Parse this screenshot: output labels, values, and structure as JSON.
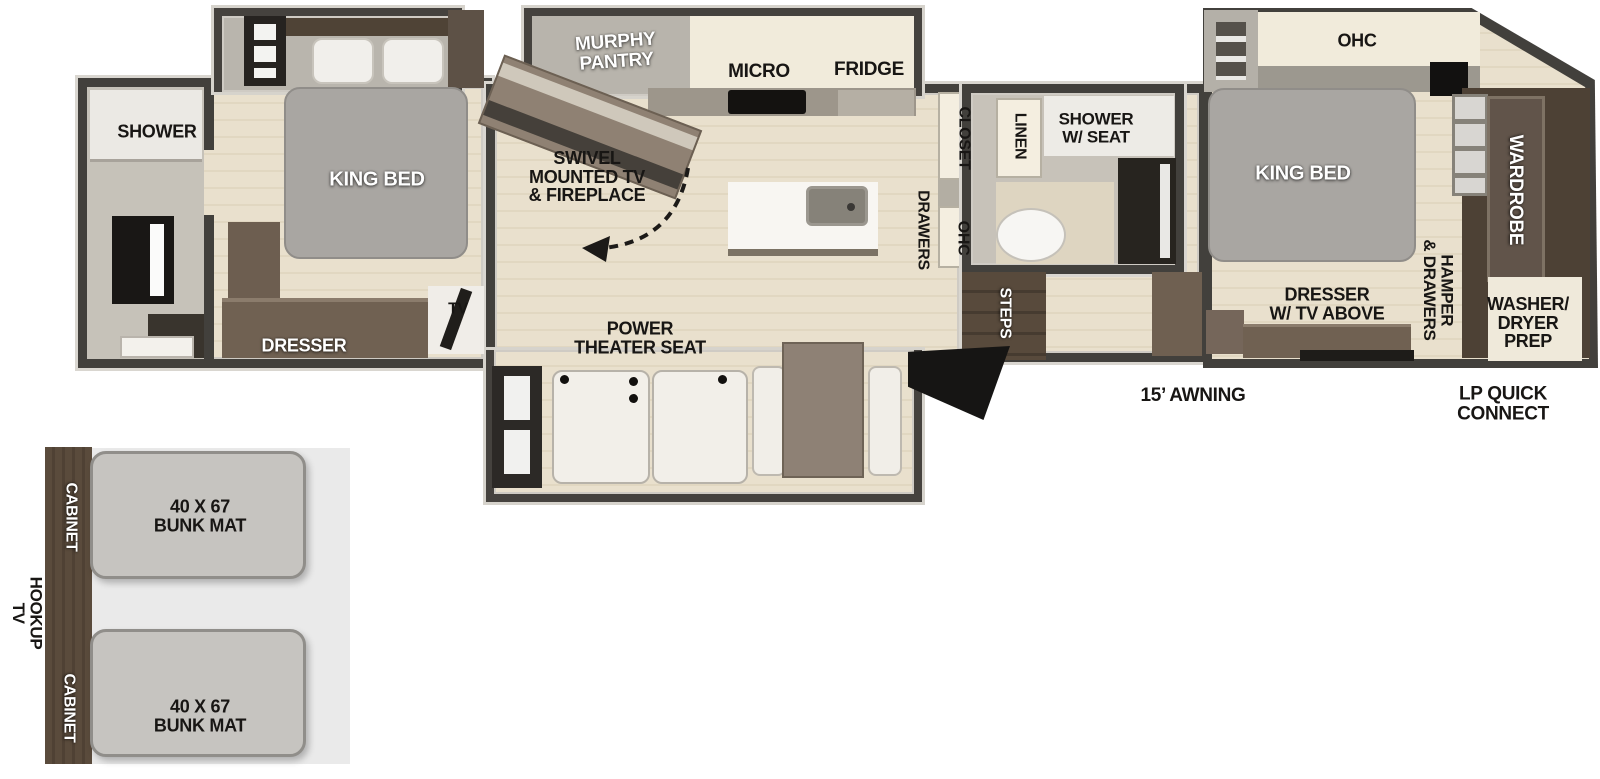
{
  "labels": {
    "rear_bath_shower": "SHOWER",
    "rear_king_bed": "KING BED",
    "rear_dresser": "DRESSER",
    "rear_tv": "TV",
    "murphy_pantry": "MURPHY\nPANTRY",
    "micro": "MICRO",
    "fridge": "FRIDGE",
    "swivel_tv": "SWIVEL\nMOUNTED TV\n& FIREPLACE",
    "power_theater_seat": "POWER\nTHEATER SEAT",
    "closet": "CLOSET",
    "drawers": "DRAWERS",
    "ohc_mid": "OHC",
    "linen": "LINEN",
    "shower_w_seat": "SHOWER\nW/ SEAT",
    "steps": "STEPS",
    "ohc_front": "OHC",
    "front_king_bed": "KING BED",
    "dresser_tv_above": "DRESSER\nW/ TV ABOVE",
    "hamper_drawers": "HAMPER\n& DRAWERS",
    "wardrobe": "WARDROBE",
    "washer_dryer_prep": "WASHER/\nDRYER\nPREP",
    "awning": "15’ AWNING",
    "lp_quick_connect": "LP QUICK\nCONNECT",
    "tv_hookup": "TV\nHOOKUP",
    "cabinet_upper": "CABINET",
    "cabinet_lower": "CABINET",
    "bunk_mat_upper": "40 X 67\nBUNK MAT",
    "bunk_mat_lower": "40 X 67\nBUNK MAT"
  },
  "colors": {
    "wall": "#42403c",
    "floor_wood": "#e6dcc7",
    "floor_gray": "#c2beb5",
    "furniture_brown": "#706152",
    "front_closet_brown": "#4d4135",
    "bed_gray": "#a9a6a2",
    "cabinet_cream": "#f1ebdb",
    "bunk_mat_gray": "#c6c4c0"
  }
}
